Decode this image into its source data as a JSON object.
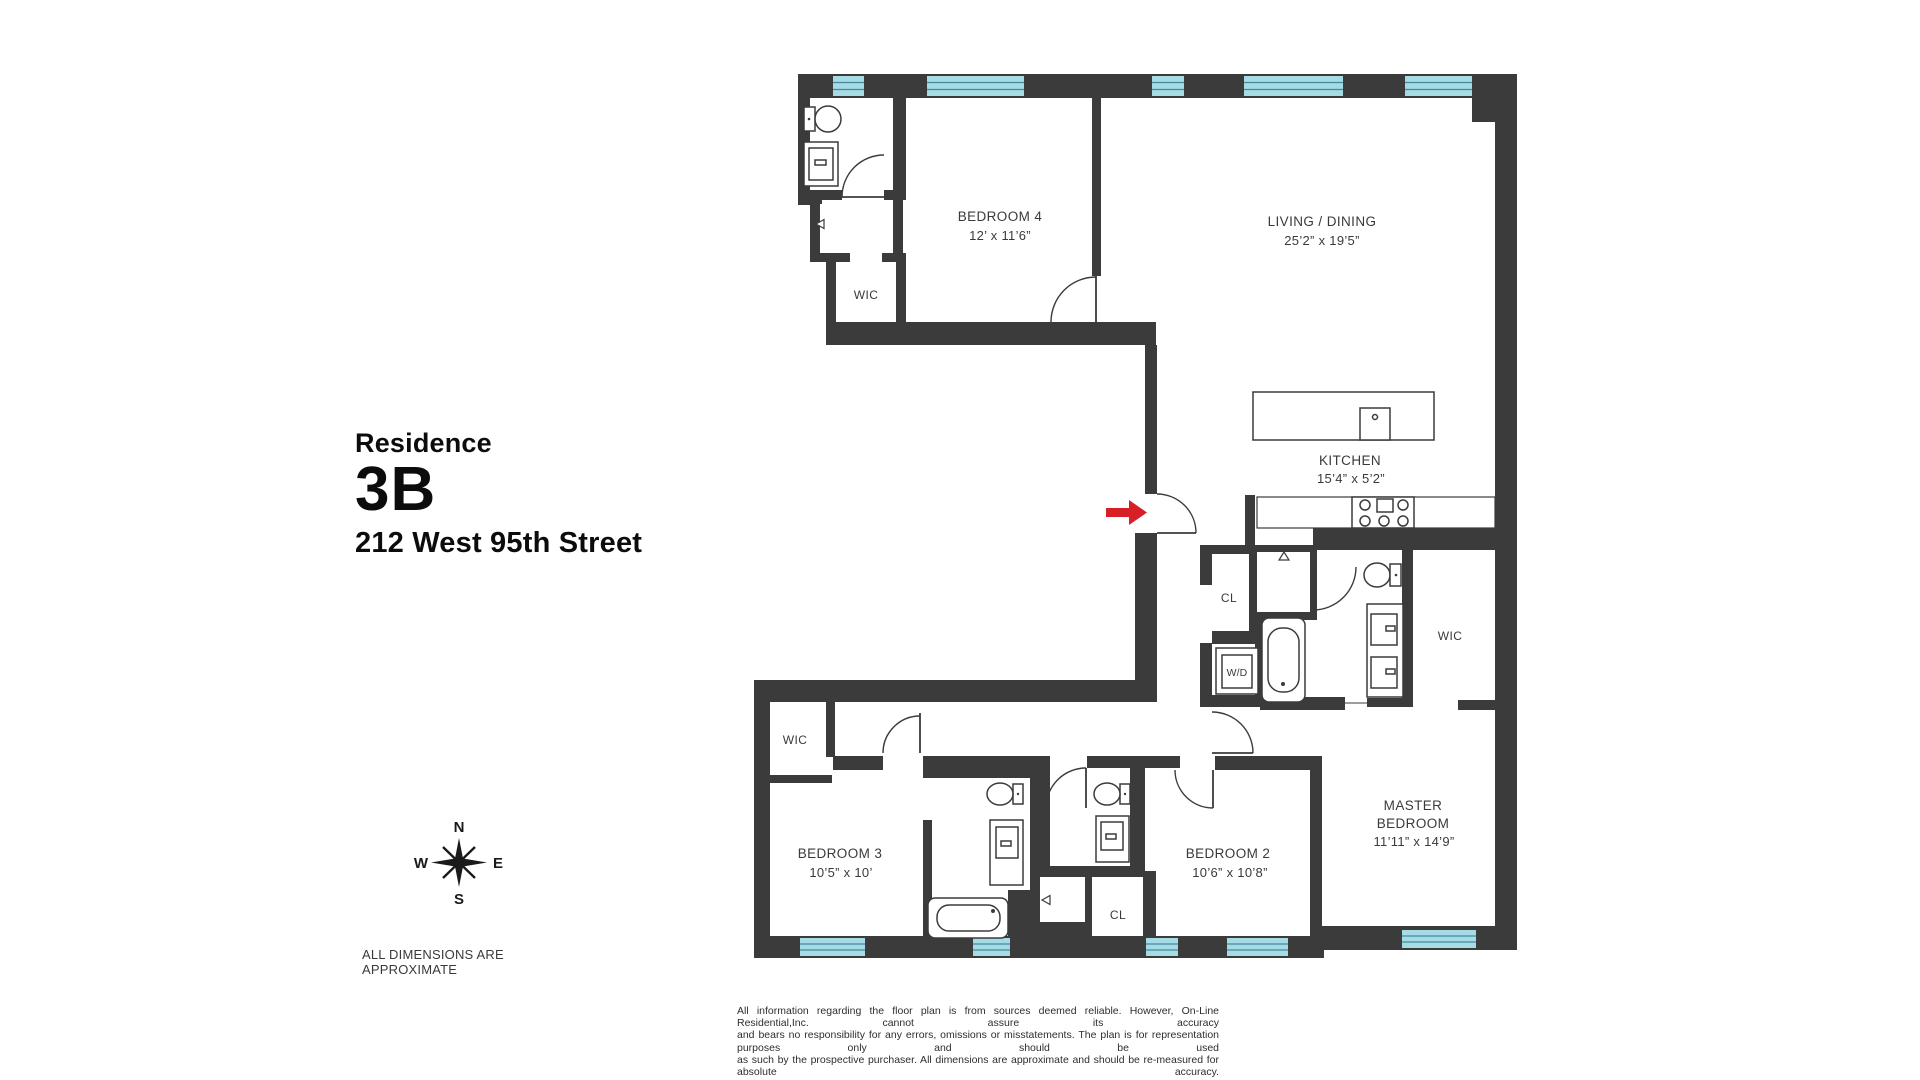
{
  "title_block": {
    "label": "Residence",
    "unit": "3B",
    "address": "212 West 95th Street"
  },
  "compass": {
    "n": "N",
    "s": "S",
    "e": "E",
    "w": "W"
  },
  "dimensions_note": "ALL DIMENSIONS ARE APPROXIMATE",
  "disclaimer": {
    "line1": "All information regarding the floor plan is from sources deemed reliable. However, On-Line Residential,Inc. cannot assure its accuracy",
    "line2": "and bears no responsibility for any errors, omissions or misstatements. The plan is for representation purposes only and should be used",
    "line3": "as such by the prospective purchaser. All dimensions are approximate and should be re-measured for absolute accuracy."
  },
  "rooms": {
    "bedroom4": {
      "name": "BEDROOM 4",
      "dims": "12’ x 11’6”"
    },
    "living": {
      "name": "LIVING / DINING",
      "dims": "25’2” x 19’5”"
    },
    "kitchen": {
      "name": "KITCHEN",
      "dims": "15’4” x 5’2”"
    },
    "bedroom3": {
      "name": "BEDROOM 3",
      "dims": "10’5” x 10’"
    },
    "bedroom2": {
      "name": "BEDROOM 2",
      "dims": "10’6” x 10’8”"
    },
    "master": {
      "name1": "MASTER",
      "name2": "BEDROOM",
      "dims": "11’11” x 14’9”"
    },
    "wic_top": "WIC",
    "wic_left": "WIC",
    "wic_master": "WIC",
    "cl_foyer": "CL",
    "cl_bedroom2": "CL",
    "washer_dryer": "W/D"
  },
  "colors": {
    "wall": "#3b3b3b",
    "window_fill": "#a5dbe5",
    "window_line": "#47889c",
    "entry_arrow": "#d61f26"
  }
}
